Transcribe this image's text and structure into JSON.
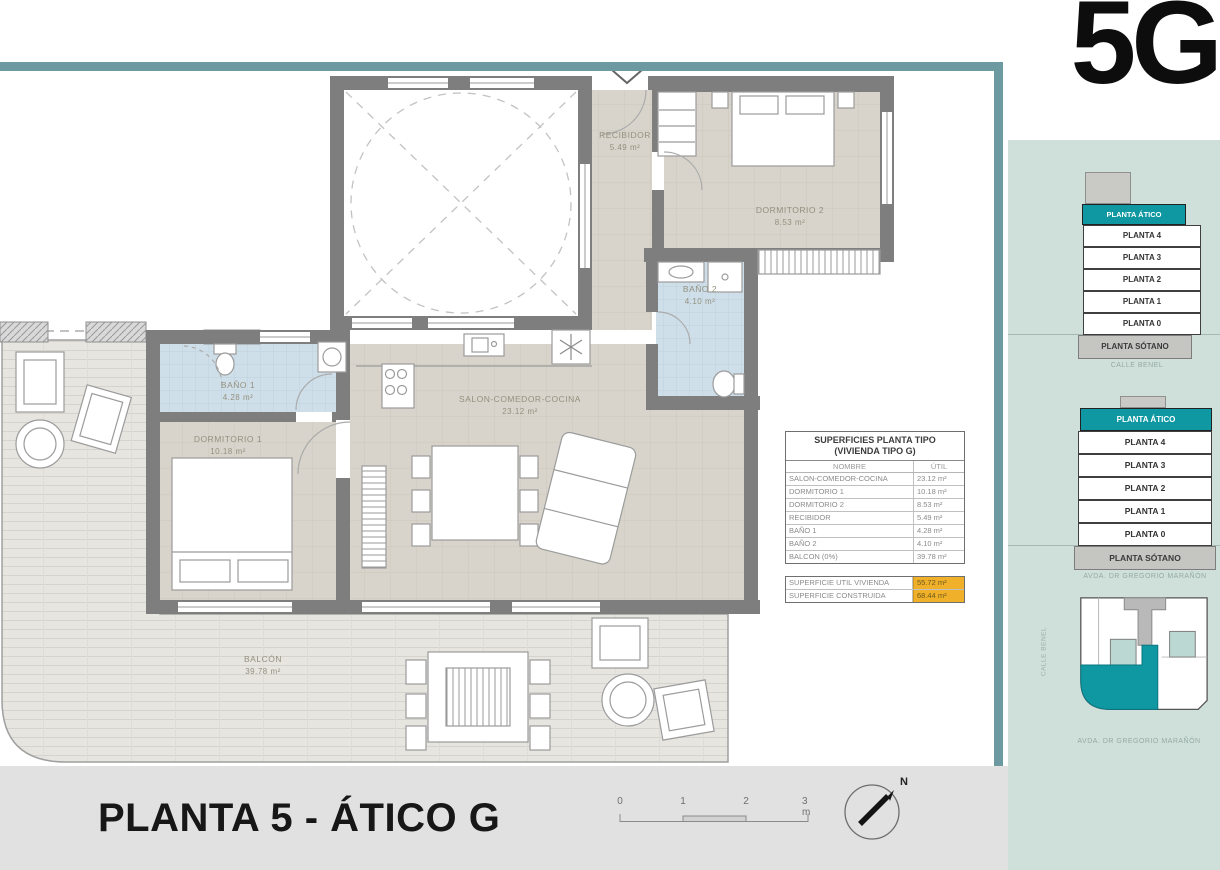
{
  "meta": {
    "unit_code": "5G"
  },
  "rooms": [
    {
      "name": "RECIBIDOR",
      "area": "5.49 m²"
    },
    {
      "name": "DORMITORIO 2",
      "area": "8.53 m²"
    },
    {
      "name": "BAÑO 2",
      "area": "4.10 m²"
    },
    {
      "name": "SALON-COMEDOR-COCINA",
      "area": "23.12 m²"
    },
    {
      "name": "BAÑO 1",
      "area": "4.28 m²"
    },
    {
      "name": "DORMITORIO 1",
      "area": "10.18 m²"
    },
    {
      "name": "BALCÓN",
      "area": "39.78 m²"
    }
  ],
  "surface_table": {
    "title_line1": "SUPERFICIES PLANTA TIPO",
    "title_line2": "(VIVIENDA TIPO G)",
    "col_name": "NOMBRE",
    "col_value": "ÚTIL",
    "rows": [
      {
        "name": "SALON-COMEDOR-COCINA",
        "value": "23.12 m²"
      },
      {
        "name": "DORMITORIO 1",
        "value": "10.18 m²"
      },
      {
        "name": "DORMITORIO 2",
        "value": "8.53 m²"
      },
      {
        "name": "RECIBIDOR",
        "value": "5.49 m²"
      },
      {
        "name": "BAÑO 1",
        "value": "4.28 m²"
      },
      {
        "name": "BAÑO 2",
        "value": "4.10 m²"
      },
      {
        "name": "BALCON (0%)",
        "value": "39.78 m²"
      }
    ],
    "summary": [
      {
        "name": "SUPERFICIE UTIL VIVIENDA",
        "value": "55.72 m²"
      },
      {
        "name": "SUPERFICIE CONSTRUIDA",
        "value": "68.44 m²"
      }
    ],
    "highlight_color": "#f0b02a"
  },
  "footer": {
    "title": "PLANTA 5 - ÁTICO G",
    "scale_ticks": [
      "0",
      "1",
      "2",
      "3 m"
    ],
    "north_label": "N"
  },
  "sidebar": {
    "bg_color": "#cfe0da",
    "accent_color": "#0f98a2",
    "stacks": [
      {
        "caption": "CALLE BENEL",
        "levels": [
          "PLANTA ÁTICO",
          "PLANTA 4",
          "PLANTA 3",
          "PLANTA 2",
          "PLANTA 1",
          "PLANTA 0",
          "PLANTA SÓTANO"
        ]
      },
      {
        "caption": "AVDA. DR GREGORIO MARAÑÓN",
        "levels": [
          "PLANTA ÁTICO",
          "PLANTA 4",
          "PLANTA 3",
          "PLANTA 2",
          "PLANTA 1",
          "PLANTA 0",
          "PLANTA SÓTANO"
        ]
      }
    ],
    "siteplan": {
      "caption": "AVDA. DR GREGORIO MARAÑÓN",
      "side_street": "CALLE BENEL"
    }
  },
  "frame_color": "#6d99a1"
}
